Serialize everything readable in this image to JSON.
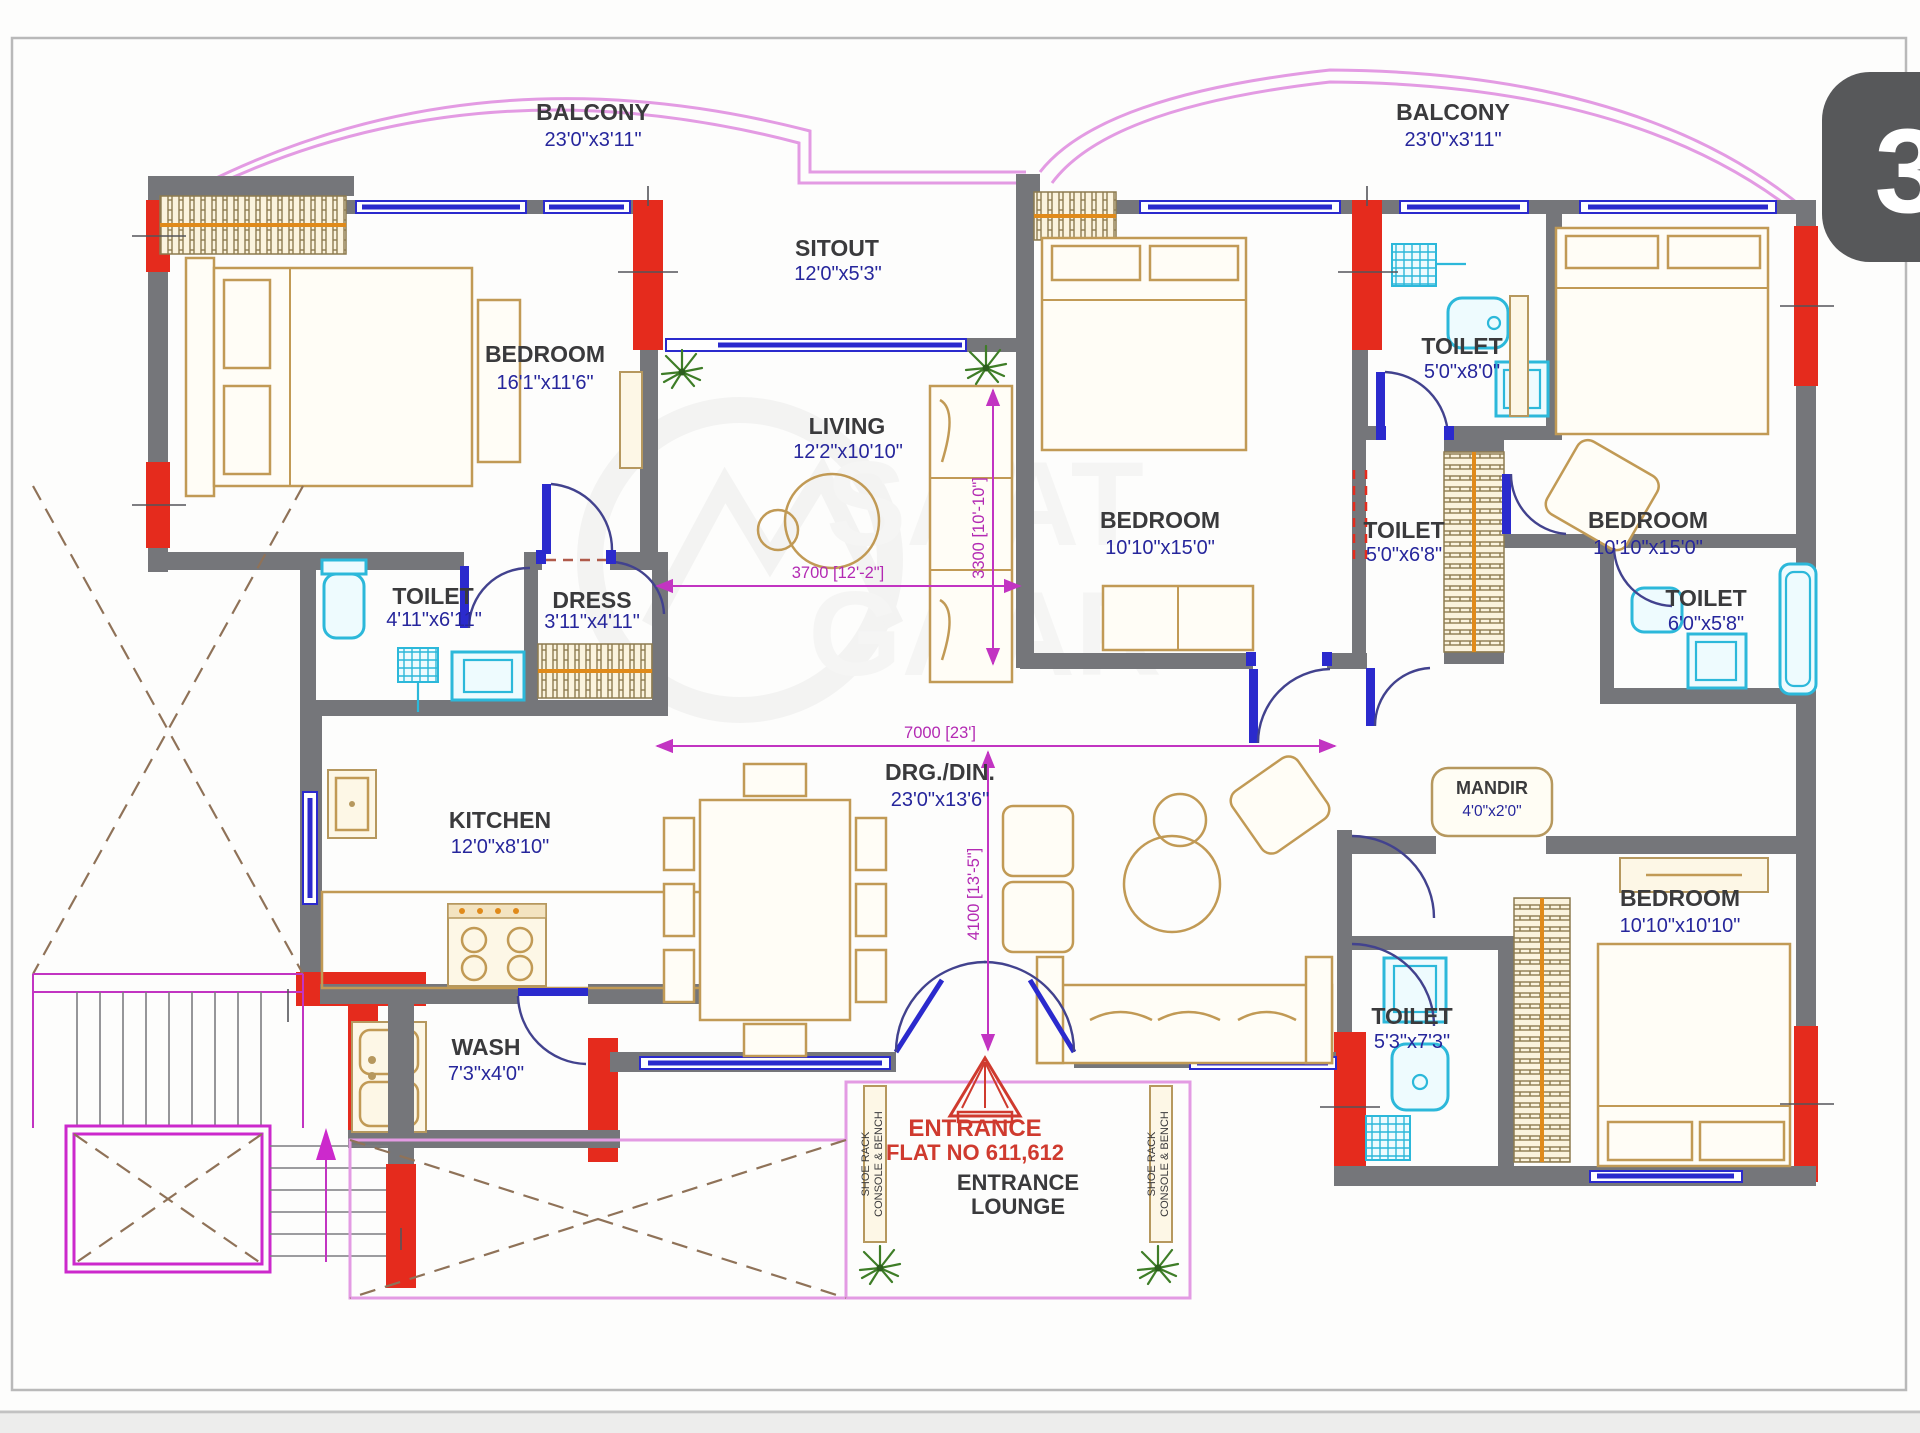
{
  "page": {
    "badge": "3"
  },
  "watermark": {
    "line1": "SAAT",
    "line2": "GAAR",
    "reg": "R"
  },
  "rooms": {
    "balcony_left": {
      "name": "BALCONY",
      "dims": "23'0\"x3'11\""
    },
    "balcony_right": {
      "name": "BALCONY",
      "dims": "23'0\"x3'11\""
    },
    "sitout": {
      "name": "SITOUT",
      "dims": "12'0\"x5'3\""
    },
    "bedroom_left": {
      "name": "BEDROOM",
      "dims": "16'1\"x11'6\""
    },
    "living": {
      "name": "LIVING",
      "dims": "12'2\"x10'10\""
    },
    "toilet_left": {
      "name": "TOILET",
      "dims": "4'11\"x6'11\""
    },
    "dress": {
      "name": "DRESS",
      "dims": "3'11\"x4'11\""
    },
    "kitchen": {
      "name": "KITCHEN",
      "dims": "12'0\"x8'10\""
    },
    "wash": {
      "name": "WASH",
      "dims": "7'3\"x4'0\""
    },
    "drg_din": {
      "name": "DRG./DIN.",
      "dims": "23'0\"x13'6\""
    },
    "bedroom_mid": {
      "name": "BEDROOM",
      "dims": "10'10\"x15'0\""
    },
    "toilet_top": {
      "name": "TOILET",
      "dims": "5'0\"x8'0\""
    },
    "toilet_mid": {
      "name": "TOILET",
      "dims": "5'0\"x6'8\""
    },
    "bedroom_right": {
      "name": "BEDROOM",
      "dims": "10'10\"x15'0\""
    },
    "toilet_right": {
      "name": "TOILET",
      "dims": "6'0\"x5'8\""
    },
    "mandir": {
      "name": "MANDIR",
      "dims": "4'0\"x2'0\""
    },
    "toilet_bottom": {
      "name": "TOILET",
      "dims": "5'3\"x7'3\""
    },
    "bedroom_bottom": {
      "name": "BEDROOM",
      "dims": "10'10\"x10'10\""
    }
  },
  "dims": {
    "d3700": "3700 [12'-2\"]",
    "d3300": "3300 [10'-10\"]",
    "d7000": "7000 [23']",
    "d4100": "4100 [13'-5\"]"
  },
  "entrance": {
    "title": "ENTRANCE",
    "flat": "FLAT NO 611,612",
    "lounge_line1": "ENTRANCE",
    "lounge_line2": "LOUNGE",
    "shoe_line1": "SHOE RACK",
    "shoe_line2": "CONSOLE & BENCH"
  },
  "colors": {
    "wall": "#75767a",
    "column_red": "#e52b1d",
    "window_blue": "#2b2acd",
    "dimension_magenta": "#c234c2",
    "balcony_pink": "#e39be3",
    "furniture_tan": "#c19a55",
    "fixture_cyan": "#2cb8da",
    "room_text": "#3a3a3c",
    "size_text": "#26269c",
    "entrance_red": "#cf3a2e",
    "stairs_magenta": "#cc29cc",
    "plant_green": "#3e7d27"
  }
}
